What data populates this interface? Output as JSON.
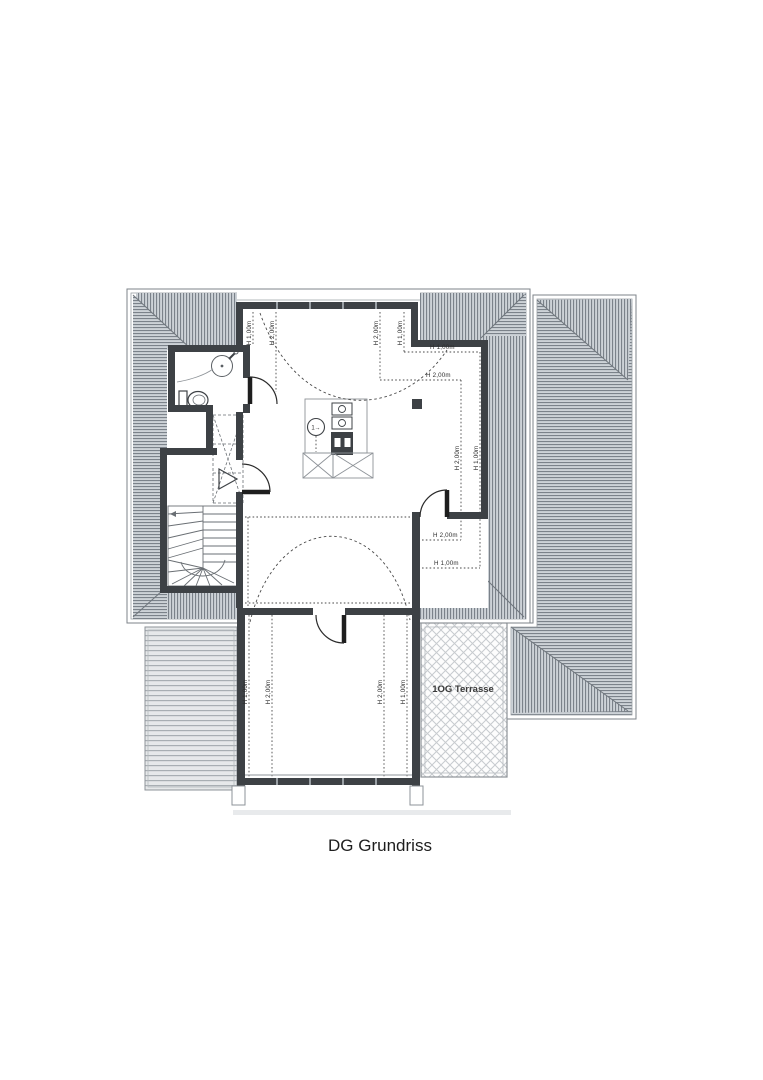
{
  "title": "DG Grundriss",
  "plan": {
    "terrace_label": "1OG Terrasse",
    "flue_marker": "1→",
    "height_labels": [
      "H 1,00m",
      "H 2,00m",
      "H 2,00m",
      "H 1,00m",
      "H 1,00m",
      "H 2,00m",
      "H 2,00m",
      "H 1,00m",
      "H 2,00m",
      "H 1,00m",
      "H 1,00m",
      "H 2,00m",
      "H 2,00m",
      "H 1,00m"
    ]
  },
  "colors": {
    "wall": "#3d4145",
    "hatch_bg": "#cdd2d7",
    "hatch_line": "#7b828a",
    "deck_bg": "#e6e8ea",
    "deck_line": "#a8aeb3",
    "contour": "#4a4a4a"
  }
}
